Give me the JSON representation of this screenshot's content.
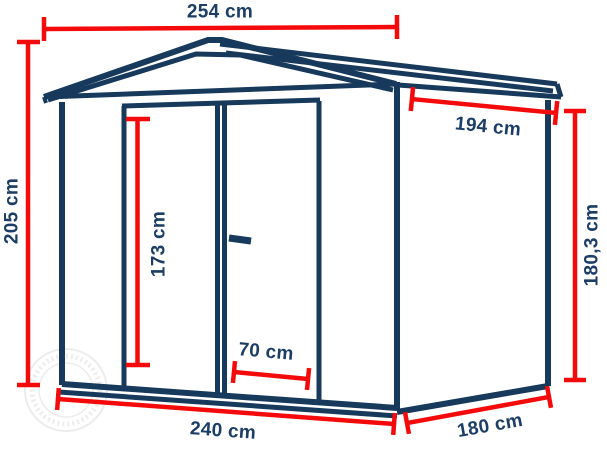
{
  "dimensions": {
    "roof_width": "254 cm",
    "total_height": "205 cm",
    "door_height": "173 cm",
    "roof_depth": "194 cm",
    "side_wall_height": "180,3 cm",
    "door_width": "70 cm",
    "base_width": "240 cm",
    "base_depth": "180 cm"
  },
  "colors": {
    "outline_navy": "#17395B",
    "dimension_red": "#F40A0A",
    "label_navy": "#1B3D66",
    "watermark_gray": "#DEDEDE",
    "background": "#FFFFFF"
  }
}
